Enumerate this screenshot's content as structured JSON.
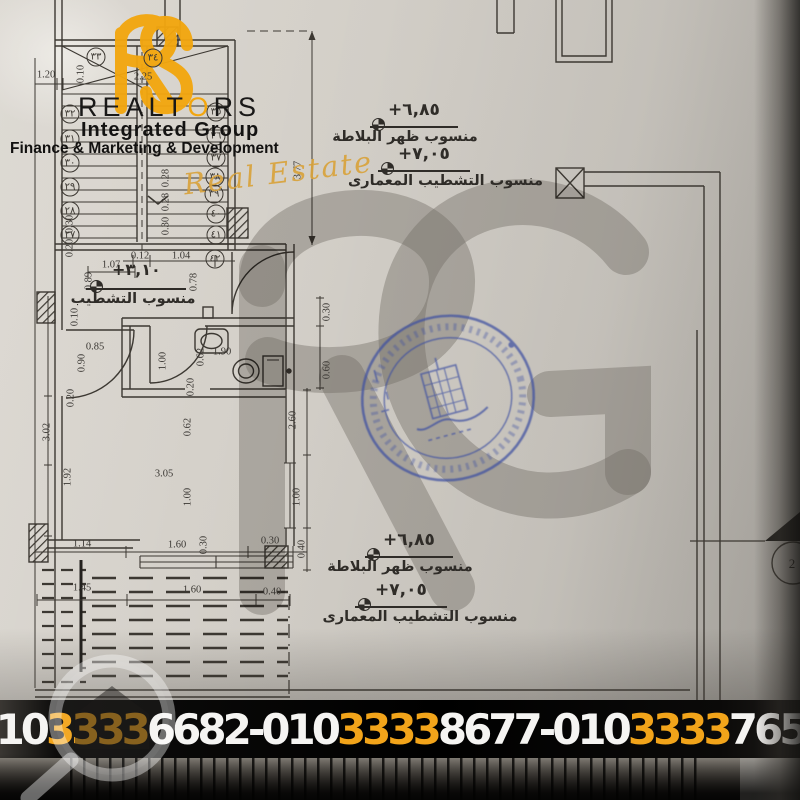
{
  "brand": {
    "name_pre": "REALT",
    "name_o": "O",
    "name_post": "RS",
    "subtitle": "Integrated Group",
    "tagline": "Finance & Marketing & Development",
    "script": "Real Estate",
    "accent": "#F2A60F"
  },
  "levels": {
    "slab": {
      "value": "+٦,٨٥",
      "label": "منسوب ظهر البلاطة"
    },
    "finish": {
      "value": "+٧,٠٥",
      "label": "منسوب التشطيب المعمارى"
    },
    "mid": {
      "value": "+٣,١٠",
      "label": "منسوب التشطيب"
    }
  },
  "section_marker": {
    "number": "2"
  },
  "stamp": {
    "color": "#3D4FA1"
  },
  "footer": {
    "separator": "-",
    "highlight": "#F2A41A",
    "phones": [
      {
        "p": "010",
        "h": "3333",
        "s": "6682"
      },
      {
        "p": "010",
        "h": "3333",
        "s": "8677"
      },
      {
        "p": "010",
        "h": "3333",
        "s": "7655"
      }
    ]
  },
  "dimensions": [
    {
      "t": "1.20",
      "x": 46,
      "y": 75
    },
    {
      "t": "0.10",
      "x": 81,
      "y": 74,
      "r": -90
    },
    {
      "t": "2.25",
      "x": 143,
      "y": 77
    },
    {
      "t": "3.77",
      "x": 298,
      "y": 170,
      "r": -90
    },
    {
      "t": "0.28",
      "x": 166,
      "y": 178,
      "r": -90
    },
    {
      "t": "0.28",
      "x": 166,
      "y": 202,
      "r": -90
    },
    {
      "t": "0.30",
      "x": 166,
      "y": 226,
      "r": -90
    },
    {
      "t": "0.30",
      "x": 70,
      "y": 224,
      "r": -90
    },
    {
      "t": "0.20",
      "x": 70,
      "y": 248,
      "r": -90
    },
    {
      "t": "1.07",
      "x": 111,
      "y": 265
    },
    {
      "t": "0.12",
      "x": 140,
      "y": 256
    },
    {
      "t": "1.04",
      "x": 181,
      "y": 256
    },
    {
      "t": "0.89",
      "x": 89,
      "y": 281,
      "r": -90
    },
    {
      "t": "0.78",
      "x": 194,
      "y": 282,
      "r": -90
    },
    {
      "t": "0.10",
      "x": 75,
      "y": 317,
      "r": -90
    },
    {
      "t": "0.85",
      "x": 95,
      "y": 347
    },
    {
      "t": "0.90",
      "x": 82,
      "y": 363,
      "r": -90
    },
    {
      "t": "0.20",
      "x": 71,
      "y": 398,
      "r": -90
    },
    {
      "t": "0.30",
      "x": 327,
      "y": 312,
      "r": -90
    },
    {
      "t": "0.60",
      "x": 327,
      "y": 370,
      "r": -90
    },
    {
      "t": "1.00",
      "x": 163,
      "y": 361,
      "r": -90
    },
    {
      "t": "0.62",
      "x": 201,
      "y": 357,
      "r": -90
    },
    {
      "t": "1.90",
      "x": 222,
      "y": 352
    },
    {
      "t": "0.20",
      "x": 191,
      "y": 387,
      "r": -90
    },
    {
      "t": "0.62",
      "x": 188,
      "y": 427,
      "r": -90
    },
    {
      "t": "3.02",
      "x": 47,
      "y": 432,
      "r": -90
    },
    {
      "t": "1.92",
      "x": 68,
      "y": 477,
      "r": -90
    },
    {
      "t": "3.05",
      "x": 164,
      "y": 474
    },
    {
      "t": "1.00",
      "x": 188,
      "y": 497,
      "r": -90
    },
    {
      "t": "2.60",
      "x": 293,
      "y": 420,
      "r": -90
    },
    {
      "t": "1.00",
      "x": 297,
      "y": 497,
      "r": -90
    },
    {
      "t": "0.40",
      "x": 302,
      "y": 549,
      "r": -90
    },
    {
      "t": "0.30",
      "x": 204,
      "y": 545,
      "r": -90
    },
    {
      "t": "1.14",
      "x": 82,
      "y": 544
    },
    {
      "t": "1.60",
      "x": 177,
      "y": 545
    },
    {
      "t": "0.30",
      "x": 270,
      "y": 541
    },
    {
      "t": "1.45",
      "x": 82,
      "y": 588
    },
    {
      "t": "1.60",
      "x": 192,
      "y": 590
    },
    {
      "t": "0.40",
      "x": 272,
      "y": 592
    }
  ],
  "stair_numbers": [
    {
      "t": "٣٣",
      "x": 96,
      "y": 57
    },
    {
      "t": "٣٤",
      "x": 153,
      "y": 58
    },
    {
      "t": "٣٢",
      "x": 70,
      "y": 114
    },
    {
      "t": "٣١",
      "x": 70,
      "y": 139
    },
    {
      "t": "٣٠",
      "x": 70,
      "y": 163
    },
    {
      "t": "٢٩",
      "x": 70,
      "y": 187
    },
    {
      "t": "٢٨",
      "x": 70,
      "y": 211
    },
    {
      "t": "٢٧",
      "x": 70,
      "y": 235
    },
    {
      "t": "٣٥",
      "x": 216,
      "y": 112
    },
    {
      "t": "٣٦",
      "x": 216,
      "y": 136
    },
    {
      "t": "٣٧",
      "x": 216,
      "y": 158
    },
    {
      "t": "٣٨",
      "x": 215,
      "y": 177
    },
    {
      "t": "٣٩",
      "x": 214,
      "y": 194
    },
    {
      "t": "٤٠",
      "x": 216,
      "y": 214
    },
    {
      "t": "٤١",
      "x": 216,
      "y": 235
    },
    {
      "t": "٤٢",
      "x": 215,
      "y": 259
    }
  ]
}
